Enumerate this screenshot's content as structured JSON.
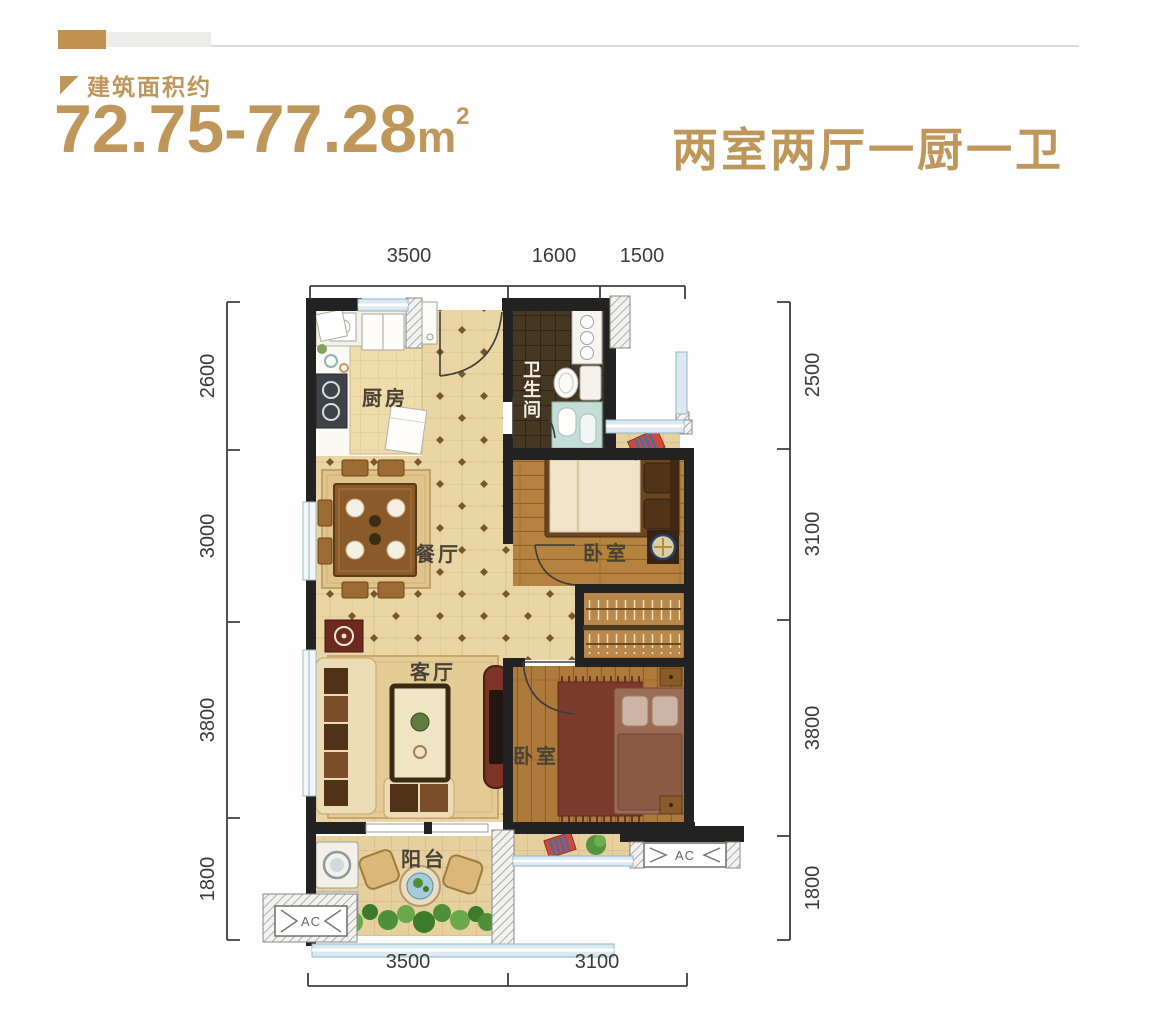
{
  "header": {
    "area_label": "建筑面积约",
    "area_value": "72.75-77.28",
    "area_unit": "m",
    "area_exp": "2",
    "layout_title": "两室两厅一厨一卫"
  },
  "plan": {
    "labels": {
      "kitchen": "厨房",
      "bathroom": "卫生间",
      "dining": "餐厅",
      "living": "客厅",
      "bedroom1": "卧室",
      "bedroom2": "卧室",
      "balcony": "阳台",
      "ac": "AC"
    },
    "dimensions": {
      "top": [
        "3500",
        "1600",
        "1500"
      ],
      "bottom": [
        "3500",
        "3100"
      ],
      "left": [
        "2600",
        "3000",
        "3800",
        "1800"
      ],
      "right": [
        "2500",
        "3100",
        "3800",
        "1800"
      ]
    }
  },
  "colors": {
    "gold": "#bf975a",
    "bar_gold": "#c2914f",
    "wall": "#222222",
    "tile": "#e9d6a4",
    "wood": "#b5823f",
    "window": "#8fb7c9"
  }
}
